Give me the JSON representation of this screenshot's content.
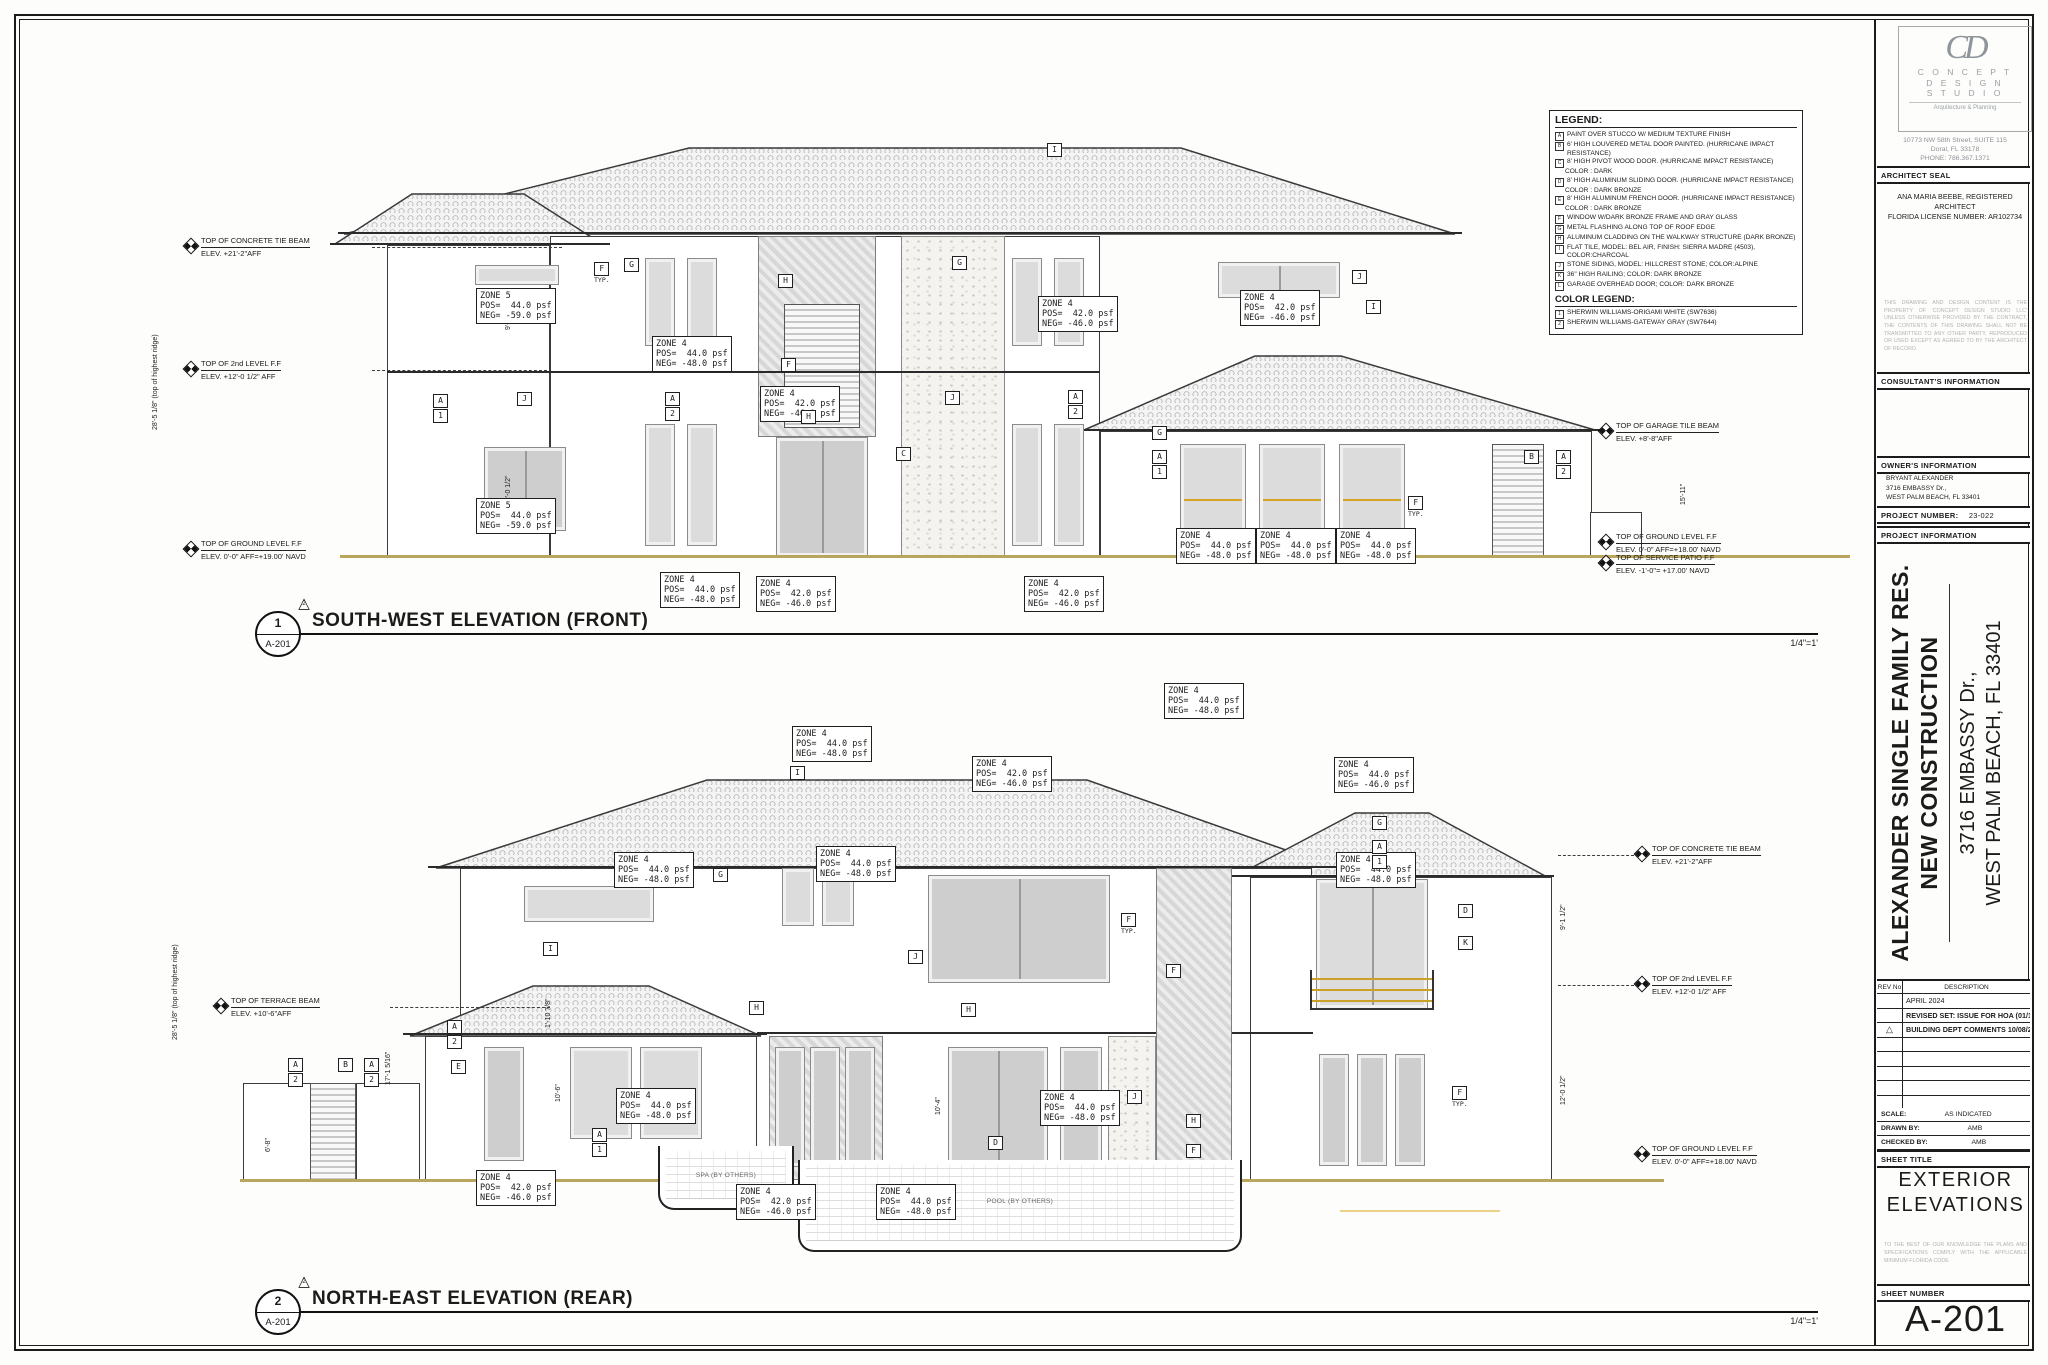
{
  "legend": {
    "title": "LEGEND:",
    "items": [
      {
        "key": "A",
        "lines": [
          "PAINT OVER STUCCO W/ MEDIUM TEXTURE FINISH"
        ]
      },
      {
        "key": "B",
        "lines": [
          "6' HIGH LOUVERED METAL DOOR PAINTED. (HURRICANE IMPACT RESISTANCE)"
        ]
      },
      {
        "key": "C",
        "lines": [
          "8' HIGH PIVOT WOOD DOOR. (HURRICANE IMPACT RESISTANCE)",
          "COLOR : DARK"
        ]
      },
      {
        "key": "D",
        "lines": [
          "8' HIGH ALUMINUM SLIDING DOOR. (HURRICANE IMPACT RESISTANCE)",
          "COLOR : DARK BRONZE"
        ]
      },
      {
        "key": "E",
        "lines": [
          "8' HIGH ALUMINUM FRENCH DOOR. (HURRICANE IMPACT RESISTANCE)",
          "COLOR : DARK BRONZE"
        ]
      },
      {
        "key": "F",
        "lines": [
          "WINDOW W/DARK BRONZE FRAME AND GRAY GLASS"
        ]
      },
      {
        "key": "G",
        "lines": [
          "METAL FLASHING ALONG TOP OF ROOF EDGE"
        ]
      },
      {
        "key": "H",
        "lines": [
          "ALUMINUM CLADDING ON THE WALKWAY STRUCTURE (DARK BRONZE)"
        ]
      },
      {
        "key": "I",
        "lines": [
          "FLAT TILE, MODEL: BEL AIR, FINISH: SIERRA MADRE (4503), COLOR:CHARCOAL"
        ]
      },
      {
        "key": "J",
        "lines": [
          "STONE SIDING, MODEL: HILLCREST STONE; COLOR:ALPINE"
        ]
      },
      {
        "key": "K",
        "lines": [
          "36\" HIGH RAILING; COLOR: DARK BRONZE"
        ]
      },
      {
        "key": "L",
        "lines": [
          "GARAGE OVERHEAD DOOR; COLOR: DARK BRONZE"
        ]
      }
    ],
    "color_title": "COLOR LEGEND:",
    "color_items": [
      {
        "key": "1",
        "label": "SHERWIN WILLIAMS-ORIGAMI WHITE (SW7636)"
      },
      {
        "key": "2",
        "label": "SHERWIN WILLIAMS-GATEWAY GRAY (SW7644)"
      }
    ]
  },
  "front": {
    "num": "1",
    "ref": "A-201",
    "title": "SOUTH-WEST ELEVATION (FRONT)",
    "scale": "1/4\"=1'",
    "delta": "2",
    "zones": [
      {
        "x": 476,
        "y": 288,
        "z": "ZONE 5",
        "p": "POS=  44.0 psf",
        "n": "NEG= -59.0 psf"
      },
      {
        "x": 476,
        "y": 498,
        "z": "ZONE 5",
        "p": "POS=  44.0 psf",
        "n": "NEG= -59.0 psf"
      },
      {
        "x": 652,
        "y": 336,
        "z": "ZONE 4",
        "p": "POS=  44.0 psf",
        "n": "NEG= -48.0 psf"
      },
      {
        "x": 760,
        "y": 386,
        "z": "ZONE 4",
        "p": "POS=  42.0 psf",
        "n": "NEG= -46.0 psf"
      },
      {
        "x": 1038,
        "y": 296,
        "z": "ZONE 4",
        "p": "POS=  42.0 psf",
        "n": "NEG= -46.0 psf"
      },
      {
        "x": 1240,
        "y": 290,
        "z": "ZONE 4",
        "p": "POS=  42.0 psf",
        "n": "NEG= -46.0 psf"
      },
      {
        "x": 1176,
        "y": 528,
        "z": "ZONE 4",
        "p": "POS=  44.0 psf",
        "n": "NEG= -48.0 psf"
      },
      {
        "x": 1256,
        "y": 528,
        "z": "ZONE 4",
        "p": "POS=  44.0 psf",
        "n": "NEG= -48.0 psf"
      },
      {
        "x": 1336,
        "y": 528,
        "z": "ZONE 4",
        "p": "POS=  44.0 psf",
        "n": "NEG= -48.0 psf"
      },
      {
        "x": 660,
        "y": 572,
        "z": "ZONE 4",
        "p": "POS=  44.0 psf",
        "n": "NEG= -48.0 psf"
      },
      {
        "x": 756,
        "y": 576,
        "z": "ZONE 4",
        "p": "POS=  42.0 psf",
        "n": "NEG= -46.0 psf"
      },
      {
        "x": 1024,
        "y": 576,
        "z": "ZONE 4",
        "p": "POS=  42.0 psf",
        "n": "NEG= -46.0 psf"
      }
    ],
    "tags": [
      {
        "x": 594,
        "y": 262,
        "t": "F",
        "sub": "TYP."
      },
      {
        "x": 624,
        "y": 258,
        "t": "G"
      },
      {
        "x": 778,
        "y": 274,
        "t": "H"
      },
      {
        "x": 952,
        "y": 256,
        "t": "G"
      },
      {
        "x": 1047,
        "y": 143,
        "t": "I"
      },
      {
        "x": 433,
        "y": 394,
        "t": "A",
        "b": "1"
      },
      {
        "x": 517,
        "y": 392,
        "t": "J"
      },
      {
        "x": 665,
        "y": 392,
        "t": "A",
        "b": "2"
      },
      {
        "x": 781,
        "y": 358,
        "t": "F"
      },
      {
        "x": 801,
        "y": 410,
        "t": "H"
      },
      {
        "x": 896,
        "y": 447,
        "t": "C"
      },
      {
        "x": 945,
        "y": 391,
        "t": "J"
      },
      {
        "x": 1068,
        "y": 390,
        "t": "A",
        "b": "2"
      },
      {
        "x": 1352,
        "y": 270,
        "t": "J"
      },
      {
        "x": 1366,
        "y": 300,
        "t": "I"
      },
      {
        "x": 1152,
        "y": 426,
        "t": "G"
      },
      {
        "x": 1152,
        "y": 450,
        "t": "A",
        "b": "1"
      },
      {
        "x": 1408,
        "y": 496,
        "t": "F",
        "sub": "TYP."
      },
      {
        "x": 1524,
        "y": 450,
        "t": "B"
      },
      {
        "x": 1556,
        "y": 450,
        "t": "A",
        "b": "2"
      }
    ],
    "markers": [
      {
        "x": 185,
        "y": 236,
        "label": "TOP OF CONCRETE TIE BEAM",
        "elev": "ELEV. +21'-2\"AFF",
        "dash": {
          "x": 372,
          "w": 190
        }
      },
      {
        "x": 185,
        "y": 359,
        "label": "TOP OF 2nd LEVEL F.F",
        "elev": "ELEV. +12'-0 1/2\" AFF",
        "dash": {
          "x": 372,
          "w": 175
        }
      },
      {
        "x": 185,
        "y": 539,
        "label": "TOP OF GROUND LEVEL F.F",
        "elev": "ELEV. 0'-0\" AFF=+19.00' NAVD"
      },
      {
        "x": 1600,
        "y": 421,
        "label": "TOP OF GARAGE TILE BEAM",
        "elev": "ELEV. +8'-8\"AFF"
      },
      {
        "x": 1600,
        "y": 532,
        "label": "TOP OF GROUND LEVEL F.F",
        "elev": "ELEV. 0'-0\" AFF=+18.00' NAVD"
      },
      {
        "x": 1600,
        "y": 553,
        "label": "TOP OF SERVICE PATIO F.F",
        "elev": "ELEV. -1'-0\"= +17.00' NAVD"
      }
    ],
    "dims": [
      {
        "x": 152,
        "y": 430,
        "t": "28'-5 1/8\" (top of highest ridge)"
      },
      {
        "x": 505,
        "y": 330,
        "t": "9'-1 1/2\""
      },
      {
        "x": 505,
        "y": 505,
        "t": "12'-0 1/2\""
      },
      {
        "x": 1680,
        "y": 505,
        "t": "15'-11\""
      }
    ]
  },
  "rear": {
    "num": "2",
    "ref": "A-201",
    "title": "NORTH-EAST ELEVATION (REAR)",
    "scale": "1/4\"=1'",
    "delta": "2",
    "spa_label": "SPA (BY OTHERS)",
    "pool_label": "POOL (BY OTHERS)",
    "zones": [
      {
        "x": 1164,
        "y": 683,
        "z": "ZONE 4",
        "p": "POS=  44.0 psf",
        "n": "NEG= -48.0 psf"
      },
      {
        "x": 792,
        "y": 726,
        "z": "ZONE 4",
        "p": "POS=  44.0 psf",
        "n": "NEG= -48.0 psf"
      },
      {
        "x": 972,
        "y": 756,
        "z": "ZONE 4",
        "p": "POS=  42.0 psf",
        "n": "NEG= -46.0 psf"
      },
      {
        "x": 1334,
        "y": 757,
        "z": "ZONE 4",
        "p": "POS=  44.0 psf",
        "n": "NEG= -46.0 psf"
      },
      {
        "x": 816,
        "y": 846,
        "z": "ZONE 4",
        "p": "POS=  44.0 psf",
        "n": "NEG= -48.0 psf"
      },
      {
        "x": 614,
        "y": 852,
        "z": "ZONE 4",
        "p": "POS=  44.0 psf",
        "n": "NEG= -48.0 psf"
      },
      {
        "x": 1336,
        "y": 852,
        "z": "ZONE 4",
        "p": "POS=  44.0 psf",
        "n": "NEG= -48.0 psf"
      },
      {
        "x": 616,
        "y": 1088,
        "z": "ZONE 4",
        "p": "POS=  44.0 psf",
        "n": "NEG= -48.0 psf"
      },
      {
        "x": 1040,
        "y": 1090,
        "z": "ZONE 4",
        "p": "POS=  44.0 psf",
        "n": "NEG= -48.0 psf"
      },
      {
        "x": 476,
        "y": 1170,
        "z": "ZONE 4",
        "p": "POS=  42.0 psf",
        "n": "NEG= -46.0 psf"
      },
      {
        "x": 736,
        "y": 1184,
        "z": "ZONE 4",
        "p": "POS=  42.0 psf",
        "n": "NEG= -46.0 psf"
      },
      {
        "x": 876,
        "y": 1184,
        "z": "ZONE 4",
        "p": "POS=  44.0 psf",
        "n": "NEG= -48.0 psf"
      }
    ],
    "tags": [
      {
        "x": 790,
        "y": 766,
        "t": "I"
      },
      {
        "x": 543,
        "y": 942,
        "t": "I"
      },
      {
        "x": 713,
        "y": 868,
        "t": "G"
      },
      {
        "x": 908,
        "y": 950,
        "t": "J"
      },
      {
        "x": 749,
        "y": 1001,
        "t": "H"
      },
      {
        "x": 961,
        "y": 1003,
        "t": "H"
      },
      {
        "x": 1121,
        "y": 913,
        "t": "F",
        "sub": "TYP."
      },
      {
        "x": 1166,
        "y": 964,
        "t": "F"
      },
      {
        "x": 1372,
        "y": 816,
        "t": "G"
      },
      {
        "x": 1372,
        "y": 840,
        "t": "A",
        "b": "1"
      },
      {
        "x": 1458,
        "y": 904,
        "t": "D"
      },
      {
        "x": 1458,
        "y": 936,
        "t": "K"
      },
      {
        "x": 288,
        "y": 1058,
        "t": "A",
        "b": "2"
      },
      {
        "x": 338,
        "y": 1058,
        "t": "B"
      },
      {
        "x": 364,
        "y": 1058,
        "t": "A",
        "b": "2"
      },
      {
        "x": 447,
        "y": 1020,
        "t": "A",
        "b": "2"
      },
      {
        "x": 451,
        "y": 1060,
        "t": "E"
      },
      {
        "x": 592,
        "y": 1128,
        "t": "A",
        "b": "1"
      },
      {
        "x": 988,
        "y": 1136,
        "t": "D"
      },
      {
        "x": 1127,
        "y": 1090,
        "t": "J"
      },
      {
        "x": 1186,
        "y": 1114,
        "t": "H"
      },
      {
        "x": 1186,
        "y": 1144,
        "t": "F"
      },
      {
        "x": 1452,
        "y": 1086,
        "t": "F",
        "sub": "TYP."
      }
    ],
    "markers": [
      {
        "x": 215,
        "y": 996,
        "label": "TOP OF TERRACE BEAM",
        "elev": "ELEV. +10'-6\"AFF",
        "dash": {
          "x": 390,
          "w": 160
        }
      },
      {
        "x": 1636,
        "y": 844,
        "label": "TOP OF CONCRETE TIE BEAM",
        "elev": "ELEV. +21'-2\"AFF",
        "dash": {
          "x": 1558,
          "w": 76
        }
      },
      {
        "x": 1636,
        "y": 974,
        "label": "TOP OF 2nd LEVEL F.F",
        "elev": "ELEV. +12'-0 1/2\" AFF",
        "dash": {
          "x": 1558,
          "w": 76
        }
      },
      {
        "x": 1636,
        "y": 1144,
        "label": "TOP OF GROUND LEVEL F.F",
        "elev": "ELEV. 0'-0\" AFF=+18.00' NAVD"
      }
    ],
    "dims": [
      {
        "x": 172,
        "y": 1040,
        "t": "28'-5 1/8\" (top of highest ridge)"
      },
      {
        "x": 1560,
        "y": 930,
        "t": "9'-1 1/2\""
      },
      {
        "x": 1560,
        "y": 1105,
        "t": "12'-0 1/2\""
      },
      {
        "x": 385,
        "y": 1085,
        "t": "17'-1 5/16\""
      },
      {
        "x": 545,
        "y": 1028,
        "t": "1'-10 7/8\""
      },
      {
        "x": 555,
        "y": 1102,
        "t": "10'-6\""
      },
      {
        "x": 265,
        "y": 1152,
        "t": "6'-8\""
      },
      {
        "x": 935,
        "y": 1115,
        "t": "10'-4\""
      }
    ]
  },
  "titleblock": {
    "logo": {
      "monogram": "CD",
      "name_lines": [
        "C O N C E P T",
        "D E S I G N",
        "S T U D I O"
      ],
      "tagline": "Arquitecture & Planning"
    },
    "address_lines": [
      "10773 NW 58th Street, SUITE 115",
      "Doral, FL 33178",
      "PHONE: 786.367.1371"
    ],
    "architect_seal_label": "ARCHITECT SEAL",
    "architect_lines": [
      "ANA MARIA BEEBE, REGISTERED ARCHITECT",
      "FLORIDA LICENSE NUMBER: AR102734"
    ],
    "copyright_note": "THIS DRAWING AND DESIGN CONTENT IS THE PROPERTY OF 'CONCEPT DESIGN STUDIO LLC' UNLESS OTHERWISE PROVIDED BY THE CONTRACT, THE CONTENTS OF THIS DRAWING SHALL NOT BE TRANSMITTED TO ANY OTHER PARTY, REPRODUCED OR USED EXCEPT AS AGREED TO BY THE ARCHITECT OF RECORD.",
    "consultants_label": "CONSULTANT'S INFORMATION",
    "owners_label": "OWNER'S INFORMATION",
    "owner_lines": [
      "BRYANT ALEXANDER",
      "3716 EMBASSY Dr.,",
      "WEST PALM BEACH, FL 33401"
    ],
    "project_number_label": "PROJECT NUMBER:",
    "project_number": "23-022",
    "project_info_label": "PROJECT INFORMATION",
    "project_title_lines": [
      "ALEXANDER SINGLE FAMILY RES.",
      "NEW CONSTRUCTION"
    ],
    "project_address_lines": [
      "3716 EMBASSY Dr.,",
      "WEST PALM BEACH, FL 33401"
    ],
    "rev_table": {
      "rev_header": "REV No",
      "desc_header": "DESCRIPTION",
      "rows": [
        {
          "delta": false,
          "bold": false,
          "desc": "APRIL 2024"
        },
        {
          "delta": false,
          "bold": true,
          "desc": "REVISED SET: ISSUE FOR HOA (01/15/2024)"
        },
        {
          "delta": true,
          "bold": true,
          "desc": "BUILDING DEPT COMMENTS 10/08/24"
        },
        {
          "delta": false,
          "bold": false,
          "desc": ""
        },
        {
          "delta": false,
          "bold": false,
          "desc": ""
        },
        {
          "delta": false,
          "bold": false,
          "desc": ""
        },
        {
          "delta": false,
          "bold": false,
          "desc": ""
        },
        {
          "delta": false,
          "bold": false,
          "desc": ""
        }
      ]
    },
    "scale_label": "SCALE:",
    "scale_value": "AS INDICATED",
    "drawn_label": "DRAWN BY:",
    "drawn_value": "AMB",
    "checked_label": "CHECKED BY:",
    "checked_value": "AMB",
    "sheet_title_label": "SHEET TITLE",
    "sheet_title": "EXTERIOR ELEVATIONS",
    "compliance_note": "TO THE BEST OF OUR KNOWLEDGE THE PLANS AND SPECIFICATIONS COMPLY WITH THE APPLICABLE MINIMUM FLORIDA CODE",
    "sheet_number_label": "SHEET NUMBER",
    "sheet_number": "A-201"
  }
}
